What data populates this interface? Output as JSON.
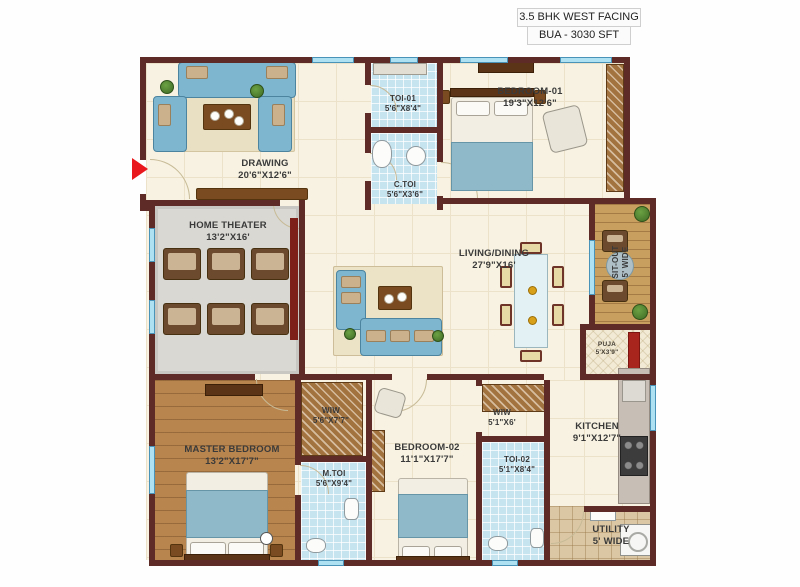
{
  "header": {
    "line1": "3.5 BHK WEST FACING",
    "line2": "BUA - 3030 SFT"
  },
  "rooms": {
    "drawing": {
      "name": "DRAWING",
      "dims": "20'6\"X12'6\""
    },
    "home_theater": {
      "name": "HOME THEATER",
      "dims": "13'2\"X16'"
    },
    "toi_01": {
      "name": "TOI-01",
      "dims": "5'6\"X8'4\""
    },
    "c_toi": {
      "name": "C.TOI",
      "dims": "5'6\"X3'6\""
    },
    "bedroom_01": {
      "name": "BEDROOM-01",
      "dims": "19'3\"X12'6\""
    },
    "living_dining": {
      "name": "LIVING/DINING",
      "dims": "27'9\"X16'"
    },
    "sit_out": {
      "name": "SIT-OUT",
      "dims": "5' WIDE"
    },
    "puja": {
      "name": "PUJA",
      "dims": "5'X3'9\""
    },
    "kitchen": {
      "name": "KITCHEN",
      "dims": "9'1\"X12'7\""
    },
    "utility": {
      "name": "UTILITY",
      "dims": "5' WIDE"
    },
    "master_bedroom": {
      "name": "MASTER BEDROOM",
      "dims": "13'2\"X17'7\""
    },
    "wiw_master": {
      "name": "WIW",
      "dims": "5'6\"X7'7\""
    },
    "m_toi": {
      "name": "M.TOI",
      "dims": "5'6\"X9'4\""
    },
    "bedroom_02": {
      "name": "BEDROOM-02",
      "dims": "11'1\"X17'7\""
    },
    "wiw_bed02": {
      "name": "WIW",
      "dims": "5'1\"X6'"
    },
    "toi_02": {
      "name": "TOI-02",
      "dims": "5'1\"X8'4\""
    }
  },
  "colors": {
    "wall": "#5f2b27",
    "window": "#aee1f2",
    "floor_cream": "#f7f2e1",
    "floor_tile": "#c6e3f0",
    "floor_wood": "#b9854e",
    "sofa_blue": "#7eb5cf",
    "entry_arrow_red": "#e8181c"
  }
}
